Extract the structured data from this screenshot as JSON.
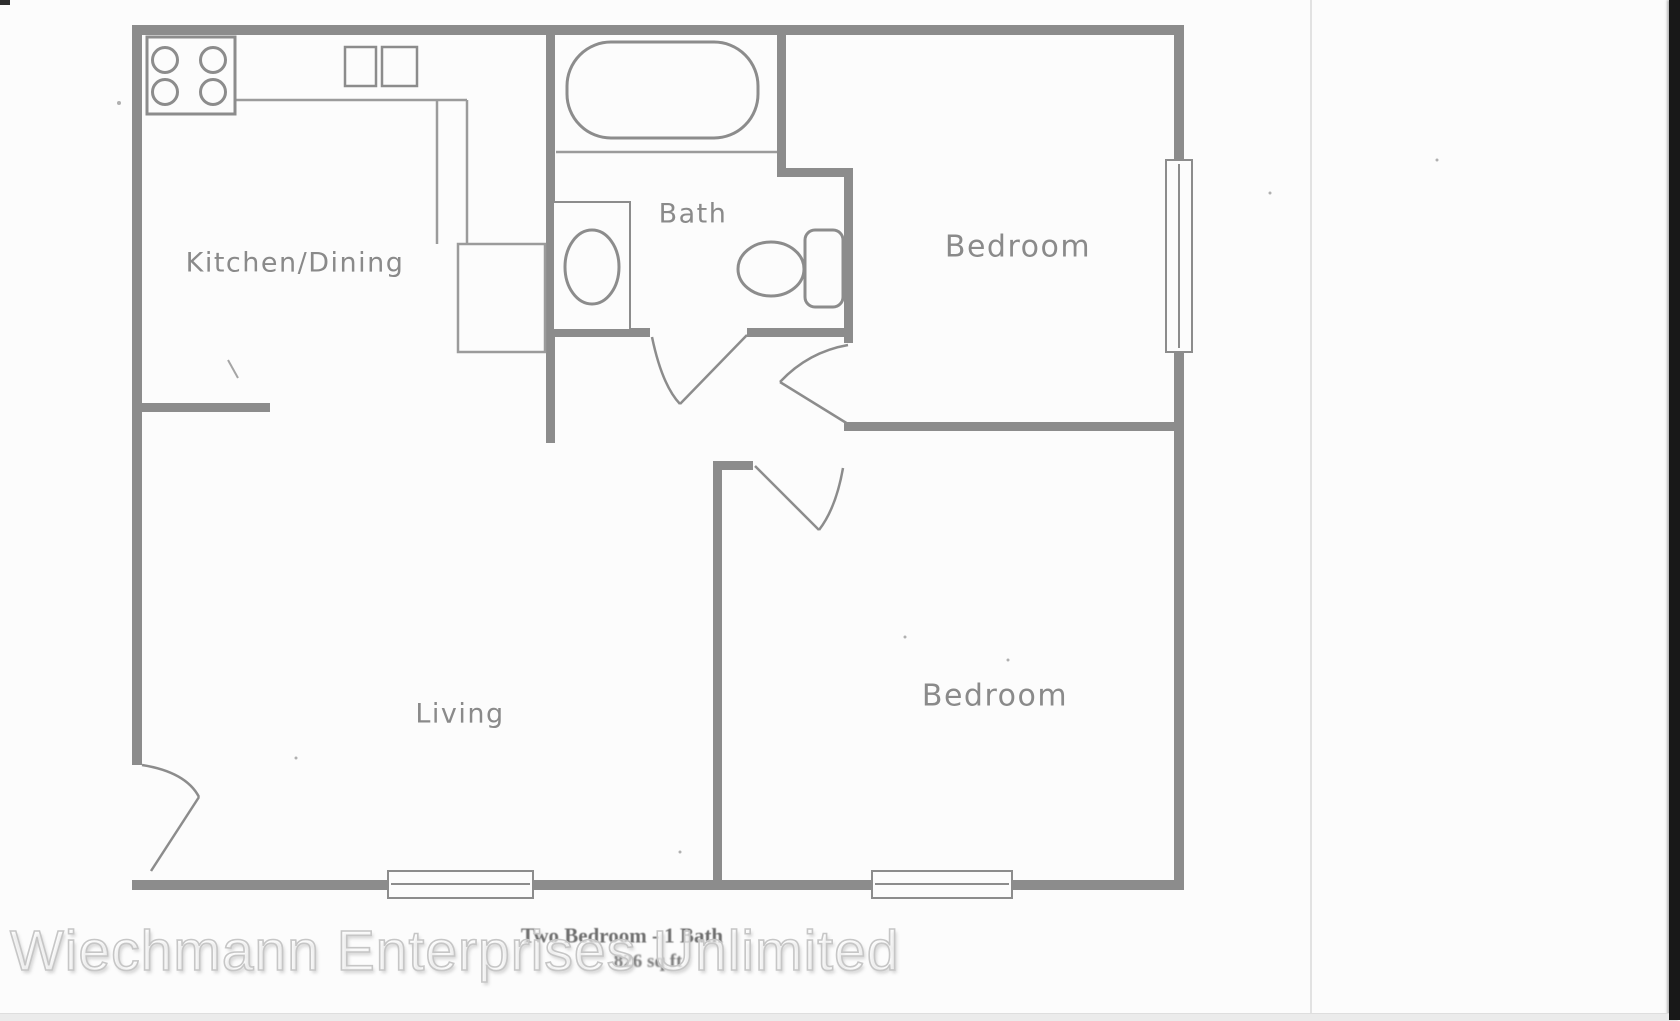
{
  "plan": {
    "type": "apartment-floor-plan",
    "rooms": [
      {
        "id": "kitchen_dining",
        "label": "Kitchen/Dining"
      },
      {
        "id": "bath",
        "label": "Bath"
      },
      {
        "id": "bedroom_top",
        "label": "Bedroom"
      },
      {
        "id": "living",
        "label": "Living"
      },
      {
        "id": "bedroom_bottom",
        "label": "Bedroom"
      }
    ],
    "caption": {
      "line1": "Two Bedroom - 1 Bath",
      "line2": "826 sq ft"
    },
    "fixtures": [
      "stove-icon",
      "kitchen-sink-icon",
      "bathtub-icon",
      "bathroom-sink-icon",
      "toilet-icon"
    ],
    "window_count": 3,
    "door_count": 4,
    "colors": {
      "wall": "#8c8c8c",
      "thin_line": "#9b9b9b",
      "label_text": "#8a8a8a",
      "paper": "#fcfcfc",
      "scan_strip": "#181818"
    }
  },
  "watermark": {
    "text": "Wiechmann Enterprises Unlimited"
  }
}
